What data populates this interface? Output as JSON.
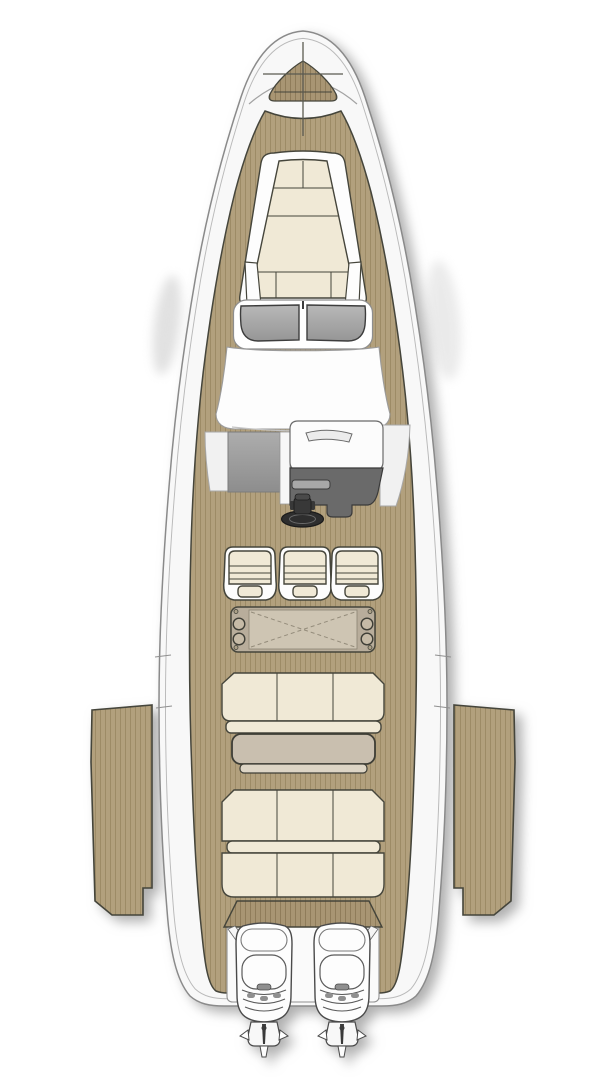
{
  "image": {
    "kind": "boat-deck-plan",
    "view": "top-down",
    "description": "Top view deck plan illustration of a sport motor yacht with teak decks, bow sun pad, windshield, centre helm, three helm seats, wet-bar unit, cockpit bench and table, aft sun pad, two fold-down side terraces and twin outboard engines",
    "width_px": 607,
    "height_px": 1080
  },
  "facts": {
    "helm_seats": 3,
    "outboard_engines": 2,
    "side_terraces": 2,
    "sun_pads": 2,
    "tables": 2
  },
  "parts": {
    "hull": "hull",
    "anchor_locker": "anchor locker",
    "bow_sunpad": "bow sun pad",
    "windshield": "windshield",
    "dashboard": "dashboard / hard top",
    "companionway": "companionway steps",
    "copilot_seat": "console hatch seat",
    "helm_console": "helm console",
    "steering_wheel": "steering wheel",
    "helm_seats": "helm seats",
    "wetbar": "wet bar / folding table unit",
    "bench_seat": "cockpit bench seat",
    "cockpit_table": "cockpit table",
    "aft_sunpad": "aft sun pad",
    "stern_walkway": "stern walkway",
    "engine_well": "engine well",
    "port_terrace": "port fold-down terrace",
    "starboard_terrace": "starboard fold-down terrace",
    "port_engine": "port outboard engine",
    "starboard_engine": "starboard outboard engine"
  },
  "palette": {
    "ink": "#45453b",
    "ink2": "#6b6b60",
    "white": "#fdfdfd",
    "hull": "#f8f8f8",
    "teak": "#b2a07d",
    "teak-line": "#9d8b66",
    "teak-dark": "#a89573",
    "teak-dark-line": "#8f7c5a",
    "cushion": "#f0e9d6",
    "glass": "#a6a6a6",
    "panel-gray": "#9e9e9e",
    "console-gray": "#6a6a6a",
    "wheel-black": "#2e2e2e",
    "table-top": "#c9bfaf",
    "table-lip": "#ddd5c5",
    "galley-body": "#b8ad9b",
    "galley-inner": "#cec5b3",
    "circle-fill": "#c6bba7"
  }
}
